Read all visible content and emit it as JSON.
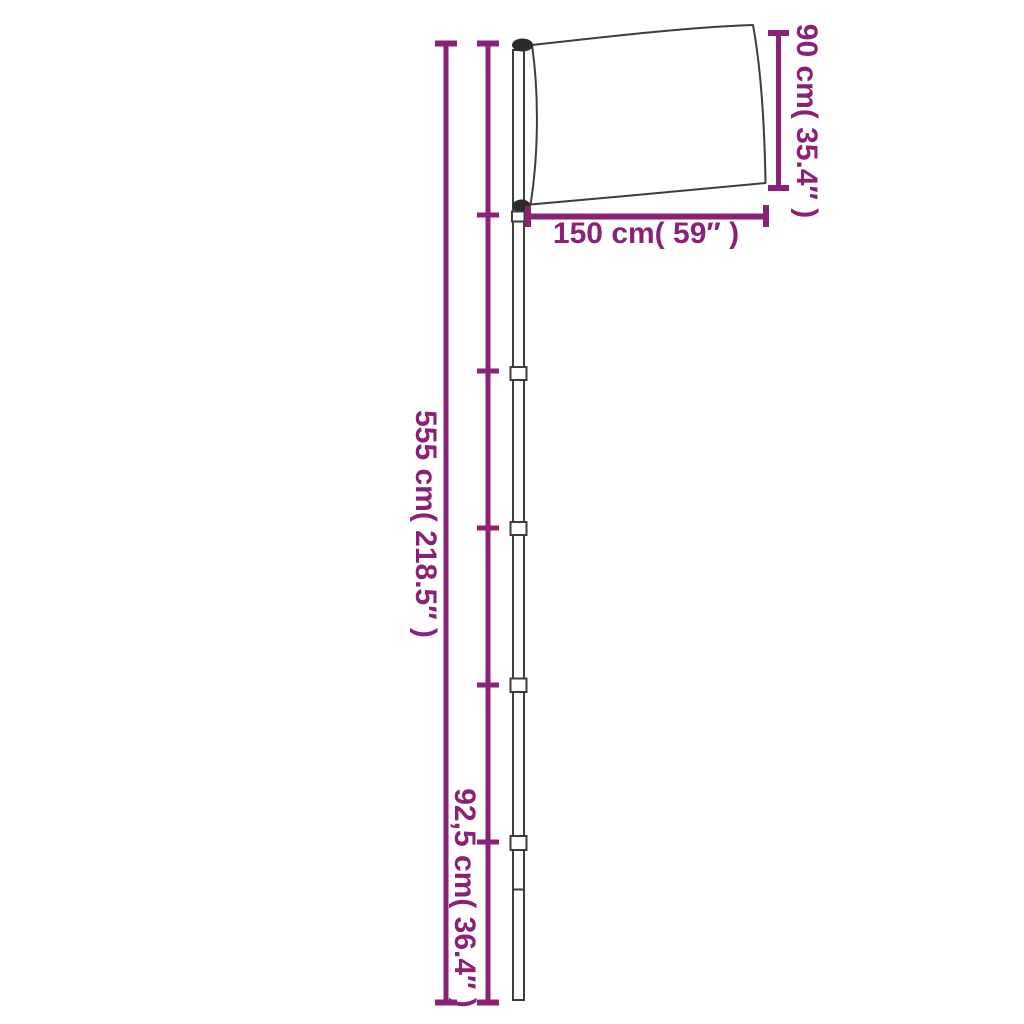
{
  "colors": {
    "accent": "#8B2176",
    "outline": "#3D3D3D",
    "hardware": "#2B2B2B",
    "background": "#FFFFFF"
  },
  "labels": {
    "pole_height": "555 cm( 218.5″ )",
    "section_height": "92,5 cm( 36.4″ )",
    "flag_width": "150 cm( 59″ )",
    "flag_height": "90 cm( 35.4″ )"
  },
  "measurements": [
    {
      "name": "pole-height",
      "cm": "555",
      "inches": "218.5",
      "orientation": "vertical"
    },
    {
      "name": "pole-section-height",
      "cm": "92,5",
      "inches": "36.4",
      "orientation": "vertical"
    },
    {
      "name": "flag-width",
      "cm": "150",
      "inches": "59",
      "orientation": "horizontal"
    },
    {
      "name": "flag-height",
      "cm": "90",
      "inches": "35.4",
      "orientation": "vertical"
    }
  ]
}
